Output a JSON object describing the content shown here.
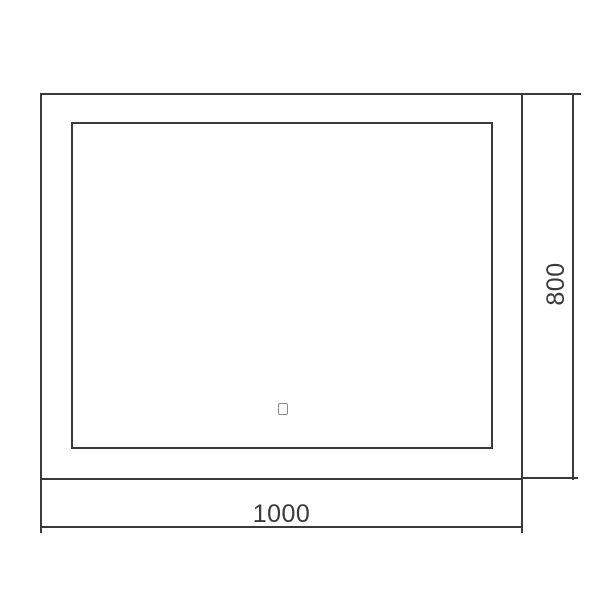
{
  "dimensions": {
    "width_label": "1000",
    "height_label": "800"
  },
  "icons": {
    "touch_sensor": "touch-sensor-icon"
  },
  "colors": {
    "background": "#ffffff",
    "line": "#3a3a3a",
    "text": "#3a3a3a",
    "icon_line": "#8f8f8f"
  }
}
